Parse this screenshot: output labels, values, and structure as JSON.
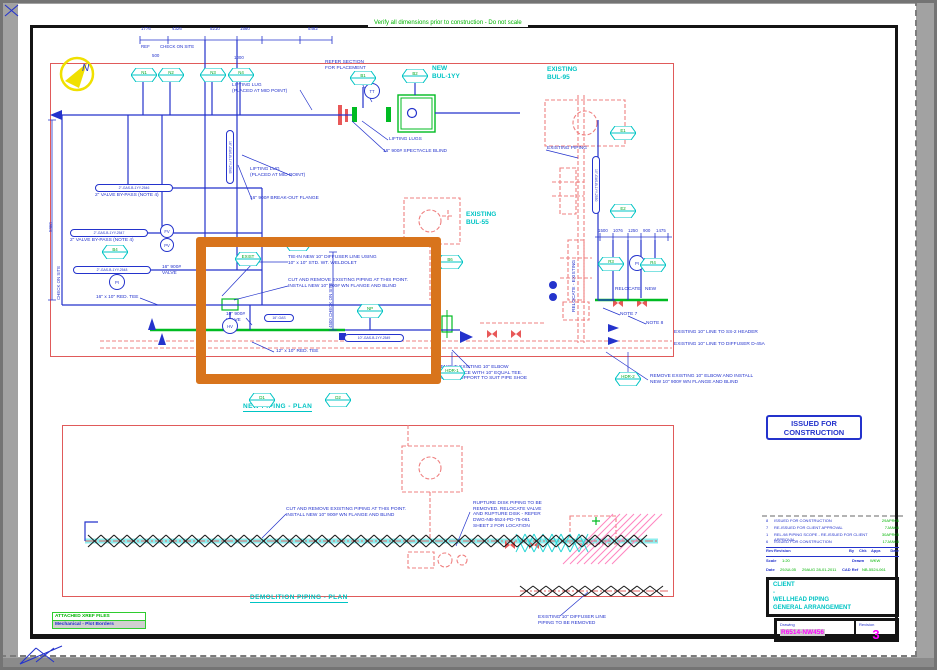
{
  "page": {
    "top_note": "Verify all dimensions prior to construction - Do not scale"
  },
  "view_titles": {
    "new_plan": "NEW PIPING - PLAN",
    "demo_plan": "DEMOLITION PIPING - PLAN"
  },
  "area_labels": {
    "new_bul": "NEW\nBUL-1YY",
    "bul95": "EXISTING\nBUL-95",
    "bul55": "EXISTING\nBUL-55",
    "existing_piping": "EXISTING PIPING"
  },
  "stamp": {
    "text": "ISSUED FOR\nCONSTRUCTION"
  },
  "callouts": {
    "refer_section": "REFER SECTION\nFOR PLACEMENT",
    "lifting_lug_mid_1": "LIFTING LUG\n(PLACED AT MID POINT)",
    "lifting_lugs": "LIFTING LUGS",
    "spectacle_blind": "16\" 900# SPECTACLE BLIND",
    "lifting_lug_mid_2": "LIFTING LUG\n(PLACED AT MID POINT)",
    "breakout_flange": "16\" 900# BREAK-OUT FLANGE",
    "valve_bypass_1": "2\" VALVE BY-PASS (NOTE 4)",
    "valve_bypass_2": "2\" VALVE BY-PASS (NOTE 4)",
    "valve_16": "16\" 900#\nVALVE",
    "red_tee_16": "16\" x 10\" RED. TEE",
    "tie_in": "TIE-IN NEW 10\" DIFFUSER LINE USING\n10\" x 10\" STD. WT. WELDOLET",
    "cut_remove_top": "CUT AND REMOVE EXISTING PIPING AT THIS POINT.\nINSTALL NEW 10\" 900# WN FLANGE AND BLIND",
    "valve_10": "10\" 900#\nVALVE",
    "red_tee_12": "12\" x 10\" RED. TEE",
    "note7": "NOTE 7",
    "note8": "NOTE 8",
    "existing_ss2": "EXISTING 10\" LINE TO SS-2 HEADER",
    "existing_diffuser": "EXISTING 10\" LINE TO DIFFUSER D-45A",
    "remove_elbow_right": "REMOVE EXISTING 10\" ELBOW AND INSTALL\nNEW 10\" 900# WN FLANGE AND BLIND",
    "remove_elbow_mid": "REMOVE EXISTING 10\" ELBOW\nAND REPLACE WITH 10\" EQUAL TEE.\nMODIFY SUPPORT TO SUIT PIPE SHOE",
    "relocate": "RELOCATE",
    "new_lbl": "NEW",
    "relocate_existing": "RELOCATE - EXISTING",
    "cut_remove_demo": "CUT AND REMOVE EXISTING PIPING AT THIS POINT.\nINSTALL NEW 10\" 900# WN FLANGE AND BLIND",
    "rupture_disk": "RUPTURE DISK PIPING TO BE\nREMOVED. RELOCATE VALVE\nAND RUPTURE DISK - REFER\nDWG-NB-5524-PD-75-061\nSHEET 2 FOR LOCATION",
    "diffuser_removed": "EXISTING 10\" DIFFUSER LINE\nPIPING TO BE REMOVED"
  },
  "dims": {
    "top": [
      "1776",
      "4326",
      "5210",
      "1560",
      "5482"
    ],
    "ref": "REF",
    "check_on_site_top": "CHECK ON SITE",
    "small1": "500",
    "small2": "1000",
    "right": [
      "1500",
      "1076",
      "1250",
      "900",
      "1475"
    ],
    "vert_4500": "4500  CHECK ON SITE",
    "left_vert": "5960",
    "check_on_site_left": "CHECK ON SITE"
  },
  "line_numbers": {
    "p1": "2\"-GAS-B-1YY-2546",
    "p2": "2\"-GAS-B-1YY-2547",
    "p3": "2\"-GAS-B-1YY-2548",
    "p4": "16\"-GAS",
    "p5": "10\"-GAS-B-1YY-2549",
    "p6": "10\"-GAS-B-1YY-2550",
    "p7": "16\"-GAS-B-1YY-2545"
  },
  "tags": [
    "N1",
    "N2",
    "N3",
    "N4",
    "B1",
    "B2",
    "E1",
    "E2",
    "R3",
    "R4",
    "B4",
    "EXIST",
    "B5",
    "NP",
    "B6",
    "HDR-2",
    "HDR-1",
    "D1",
    "D2"
  ],
  "instruments": {
    "i1": "TT",
    "i2": "FV",
    "i3": "PV",
    "i4": "PI",
    "i5": "HV",
    "i6": "PI"
  },
  "compass": {
    "letter": "N"
  },
  "xref": {
    "title": "ATTACHED XREF FILES",
    "file": "Mechanical - Plot Borders"
  },
  "titleblock": {
    "revisions": [
      {
        "rev": "8",
        "desc": "ISSUED FOR CONSTRUCTION",
        "date": "29APR06"
      },
      {
        "rev": "7",
        "desc": "RE-ISSUED FOR CLIENT APPROVAL",
        "date": "7JAN06"
      },
      {
        "rev": "1",
        "desc": "REL-98 PIPING SCOPE - RE-ISSUED FOR CLIENT APPROVAL",
        "date": "30APR05"
      },
      {
        "rev": "6",
        "desc": "ISSUED FOR CONSTRUCTION",
        "date": "17JAN05"
      }
    ],
    "header": {
      "rev": "Rev",
      "revision": "Revision",
      "by": "By",
      "chk": "Chk",
      "appr": "Appr.",
      "date": "Date"
    },
    "scale_label": "Scale",
    "scale": "1:20",
    "drawn_label": "Drawn",
    "drawn": "WKW",
    "date_label": "Date",
    "date": "29JUL05",
    "date2": "29AUG 28-01-2011",
    "cad_label": "CAD Ref",
    "cad": "NB-5524-061",
    "client_label": "CLIENT",
    "client": "-",
    "title1": "WELLHEAD PIPING",
    "title2": "GENERAL ARRANGEMENT",
    "drawing_label": "Drawing",
    "drawing_no": "R6514-NW456",
    "revision_label": "Revision",
    "revision_no": "3"
  },
  "colors": {
    "highlight_orange": "#d8741c",
    "new_blue": "#2433cc",
    "existing_red": "#ef8080",
    "green": "#00bb22",
    "cyan": "#00c4c4"
  }
}
